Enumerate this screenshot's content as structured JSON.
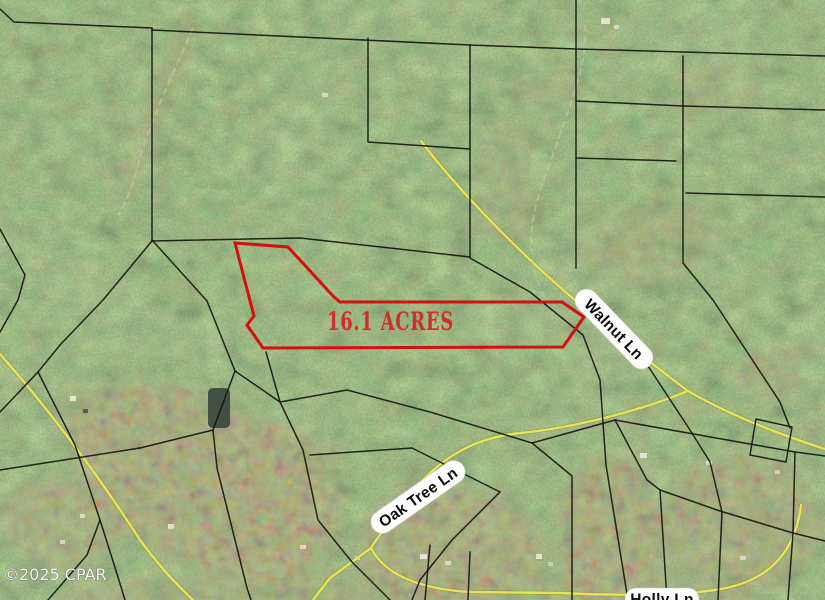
{
  "map": {
    "type": "aerial-parcel-map",
    "parcel_label": "16.1 ACRES",
    "roads": [
      {
        "name": "Walnut Ln"
      },
      {
        "name": "Oak Tree Ln"
      },
      {
        "name": "Holly Ln"
      }
    ],
    "watermark": "©2025 CPAR",
    "colors": {
      "parcel_outline": "#d40f0f",
      "parcel_label_text": "#cf2f28",
      "road_line": "#e9e456",
      "boundary_line": "#161616",
      "road_label_bg": "#ffffff",
      "road_label_text": "#0c0c0c",
      "watermark_text": "#ffffff",
      "terrain_base": "#4a5a38",
      "clearing_tan": "#cdc497"
    }
  }
}
